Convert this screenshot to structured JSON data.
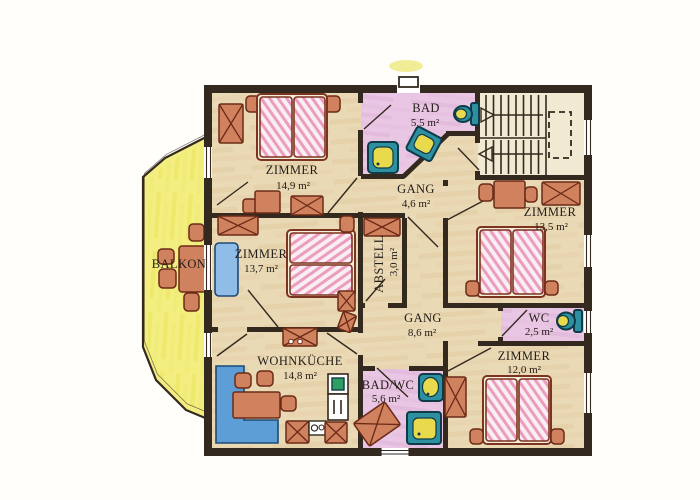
{
  "title": "Obergeschoss Wohnungsplan",
  "colors": {
    "page": "#fffefb",
    "wall": "#33291f",
    "ink": "#221d18",
    "room": "#ead9b5",
    "bath": "#e9c6e3",
    "stair": "#f1e9d2",
    "balcony": "#f3ee7f",
    "furn": "#d0815e",
    "furnline": "#6b2a16",
    "bedframe": "#f5eedb",
    "bedline": "#7c3420",
    "fixture": "#2e8fa0",
    "fixtureline": "#0d3c48",
    "fixyellow": "#e9da4d",
    "bench": "#5e9ed6",
    "benchline": "#1c4a74",
    "crib": "#8fbde8",
    "fridge": "#2f9e63"
  },
  "rooms": {
    "zimmer_nw": {
      "name": "ZIMMER",
      "area": "14,9 m²"
    },
    "bad": {
      "name": "BAD",
      "area": "5,5 m²"
    },
    "gang_top": {
      "name": "GANG",
      "area": "4,6 m²"
    },
    "zimmer_e": {
      "name": "ZIMMER",
      "area": "13,5 m²"
    },
    "zimmer_w": {
      "name": "ZIMMER",
      "area": "13,7 m²"
    },
    "abstell": {
      "name": "ABSTELL",
      "area": "3,0 m²"
    },
    "gang_main": {
      "name": "GANG",
      "area": "8,6 m²"
    },
    "wc": {
      "name": "WC",
      "area": "2,5 m²"
    },
    "wohnkueche": {
      "name": "WOHNKÜCHE",
      "area": "14,8 m²"
    },
    "bad_wc": {
      "name": "BAD/WC",
      "area": "5,6 m²"
    },
    "zimmer_se": {
      "name": "ZIMMER",
      "area": "12,0 m²"
    },
    "balkon": {
      "name": "BALKON"
    }
  }
}
